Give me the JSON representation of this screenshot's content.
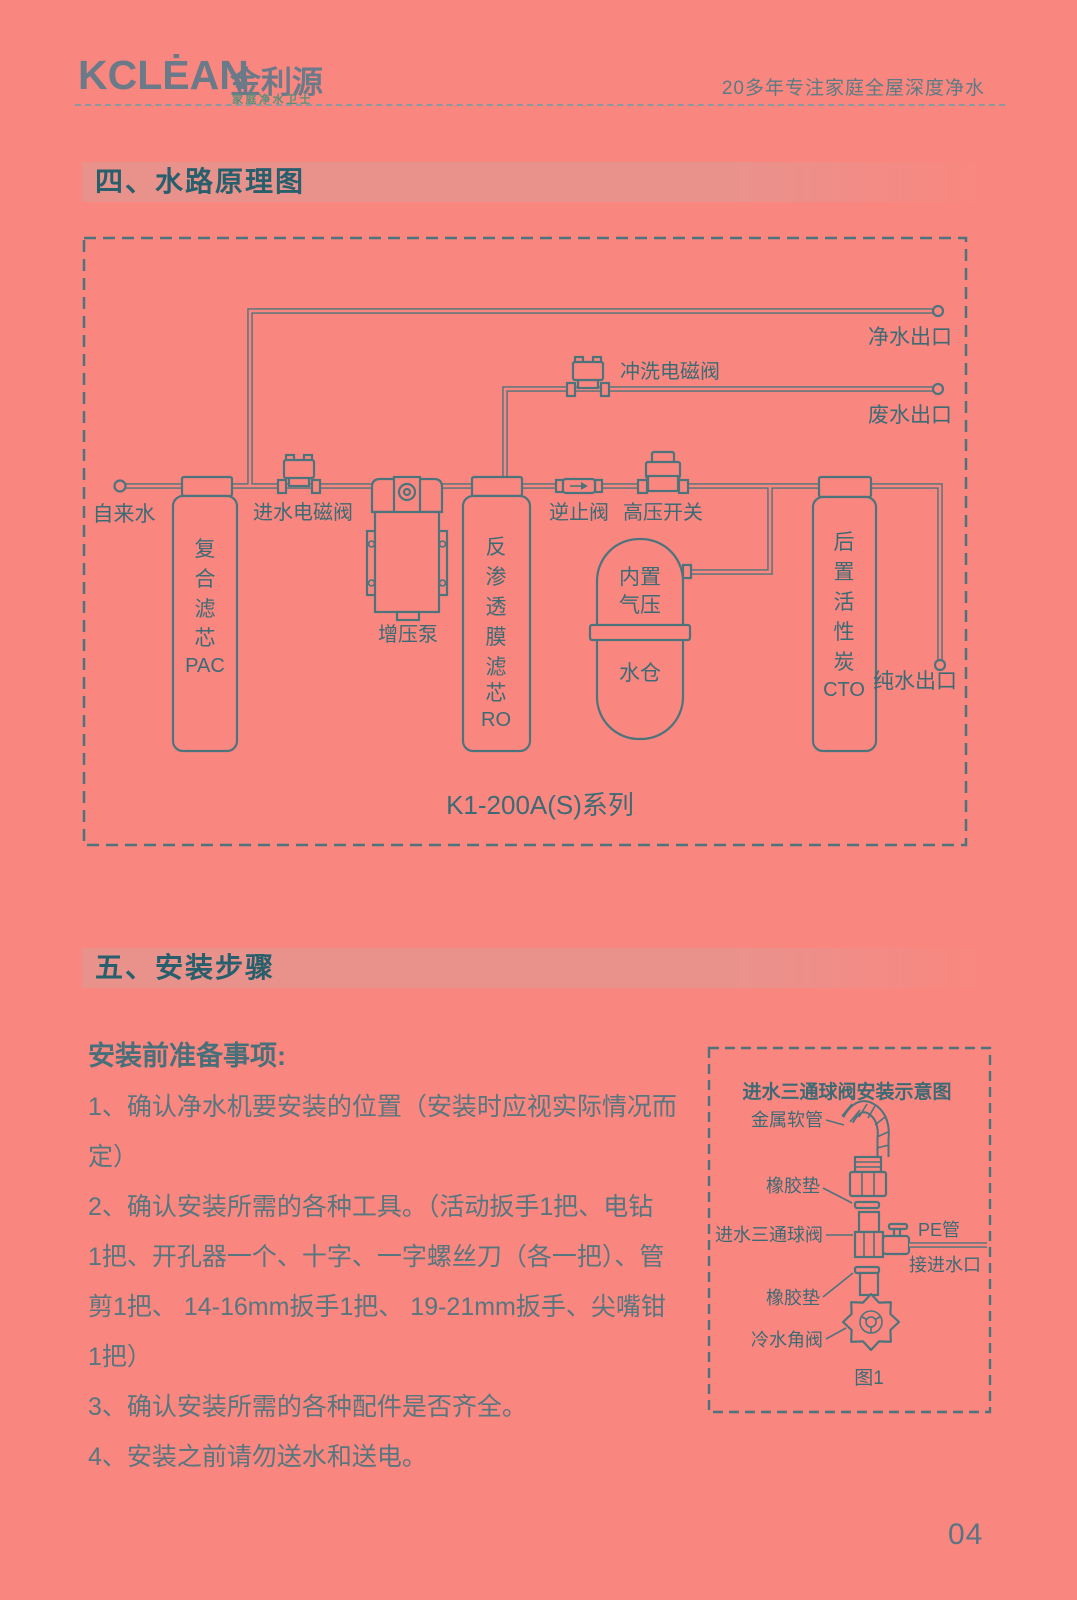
{
  "header": {
    "logo_text": "KCLĖAN",
    "logo_cn": "金利源",
    "logo_sub": "家庭净水卫士",
    "tagline": "20多年专注家庭全屋深度净水"
  },
  "sections": {
    "s4_title": "四、水路原理图",
    "s5_title": "五、安装步骤"
  },
  "main_diagram": {
    "labels": {
      "tap_water": "自来水",
      "inlet_valve": "进水电磁阀",
      "pump": "增压泵",
      "check_valve": "逆止阀",
      "hp_switch": "高压开关",
      "flush_valve": "冲洗电磁阀",
      "clean_outlet": "净水出口",
      "waste_outlet": "废水出口",
      "pure_outlet": "纯水出口",
      "series": "K1-200A(S)系列"
    },
    "pac_filter_lines": [
      "复",
      "合",
      "滤",
      "芯",
      "PAC"
    ],
    "ro_filter_lines": [
      "反",
      "渗",
      "透",
      "膜",
      "滤",
      "芯",
      "RO"
    ],
    "cto_filter_lines": [
      "后",
      "置",
      "活",
      "性",
      "炭",
      "CTO"
    ],
    "tank_lines": [
      "内置",
      "气压",
      "水仓"
    ]
  },
  "install": {
    "heading": "安装前准备事项:",
    "lines": [
      "1、确认净水机要安装的位置（安装时应视实际情况而",
      "定）",
      "2、确认安装所需的各种工具。（活动扳手1把、电钻",
      "1把、开孔器一个、十字、一字螺丝刀（各一把）、管",
      "剪1把、 14-16mm扳手1把、 19-21mm扳手、尖嘴钳",
      "1把）",
      "3、确认安装所需的各种配件是否齐全。",
      "4、安装之前请勿送水和送电。"
    ]
  },
  "inset_diagram": {
    "title": "进水三通球阀安装示意图",
    "labels": {
      "metal_hose": "金属软管",
      "rubber_gasket_1": "橡胶垫",
      "tee_ball_valve": "进水三通球阀",
      "pe_pipe": "PE管",
      "to_water_inlet": "接进水口",
      "rubber_gasket_2": "橡胶垫",
      "cold_water_angle_valve": "冷水角阀",
      "figure": "图1"
    }
  },
  "page": {
    "number": "04"
  },
  "colors": {
    "background": "#f9877f",
    "section_bar": "#e9928c",
    "section_title": "#275f6c",
    "diagram_ink": "#4d747d",
    "diagram_text": "#3c6b76",
    "body_text": "#57767f",
    "logo_gray": "#6b7a88",
    "logo_green": "#55907c"
  }
}
